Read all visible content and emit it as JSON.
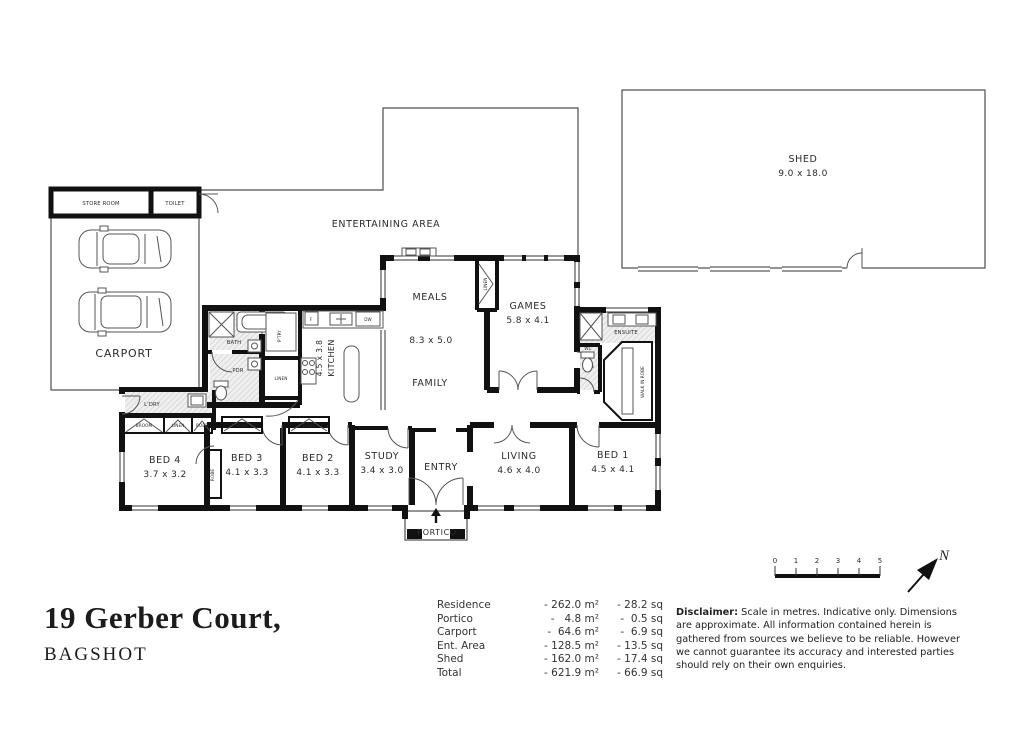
{
  "title": {
    "line1": "19 Gerber Court,",
    "line2": "BAGSHOT"
  },
  "plan": {
    "shed": {
      "name": "SHED",
      "dims": "9.0 x 18.0"
    },
    "entertaining": {
      "name": "ENTERTAINING AREA"
    },
    "carport": {
      "name": "CARPORT"
    },
    "store_room": {
      "name": "STORE ROOM"
    },
    "toilet": {
      "name": "TOILET"
    },
    "rooms": {
      "meals": {
        "name": "MEALS"
      },
      "open_dims": "8.3 x 5.0",
      "family": {
        "name": "FAMILY"
      },
      "kitchen": {
        "name": "KITCHEN",
        "dims": "4.5 x 3.8"
      },
      "games": {
        "name": "GAMES",
        "dims": "5.8 x 4.1"
      },
      "living": {
        "name": "LIVING",
        "dims": "4.6 x 4.0"
      },
      "study": {
        "name": "STUDY",
        "dims": "3.4 x 3.0"
      },
      "entry": {
        "name": "ENTRY"
      },
      "portico": {
        "name": "PORTICO"
      },
      "bed1": {
        "name": "BED 1",
        "dims": "4.5 x 4.1"
      },
      "bed2": {
        "name": "BED 2",
        "dims": "4.1 x 3.3"
      },
      "bed3": {
        "name": "BED 3",
        "dims": "4.1 x 3.3"
      },
      "bed4": {
        "name": "BED 4",
        "dims": "3.7 x 3.2"
      },
      "bath": {
        "name": "BATH"
      },
      "pdr": {
        "name": "PDR"
      },
      "pantry": {
        "name": "P'TRY"
      },
      "linen_kitchen": {
        "name": "LINEN"
      },
      "linen_games": {
        "name": "LINEN"
      },
      "laundry": {
        "name": "L'DRY"
      },
      "broom": {
        "name": "BROOM"
      },
      "linen_hall": {
        "name": "LINEN"
      },
      "robe_hall": {
        "name": "ROBE"
      },
      "robe_bed3": {
        "name": "ROBE"
      },
      "robe_bed2": {
        "name": "ROBE"
      },
      "robe_bed4": {
        "name": "ROBE"
      },
      "ensuite": {
        "name": "ENSUITE"
      },
      "wc": {
        "name": "WC"
      },
      "wir": {
        "name": "WALK IN ROBE"
      }
    },
    "fixtures": {
      "fridge": "F",
      "dishwasher": "DW"
    }
  },
  "areas": {
    "rows": [
      {
        "label": "Residence",
        "m2": "- 262.0 m²",
        "sq": "- 28.2 sq"
      },
      {
        "label": "Portico",
        "m2": "-   4.8 m²",
        "sq": "-  0.5 sq"
      },
      {
        "label": "Carport",
        "m2": "-  64.6 m²",
        "sq": "-  6.9 sq"
      },
      {
        "label": "Ent. Area",
        "m2": "- 128.5 m²",
        "sq": "- 13.5 sq"
      },
      {
        "label": "Shed",
        "m2": "- 162.0 m²",
        "sq": "- 17.4 sq"
      },
      {
        "label": "Total",
        "m2": "- 621.9 m²",
        "sq": "- 66.9 sq"
      }
    ]
  },
  "disclaimer": {
    "heading": "Disclaimer:",
    "body": " Scale in metres. Indicative only. Dimensions are approximate. All information contained herein is gathered from sources we believe to be reliable. However we cannot guarantee  its accuracy and interested parties should rely on their own enquiries."
  },
  "scale_bar": {
    "ticks": [
      "0",
      "1",
      "2",
      "3",
      "4",
      "5"
    ]
  },
  "compass": {
    "label": "N"
  }
}
